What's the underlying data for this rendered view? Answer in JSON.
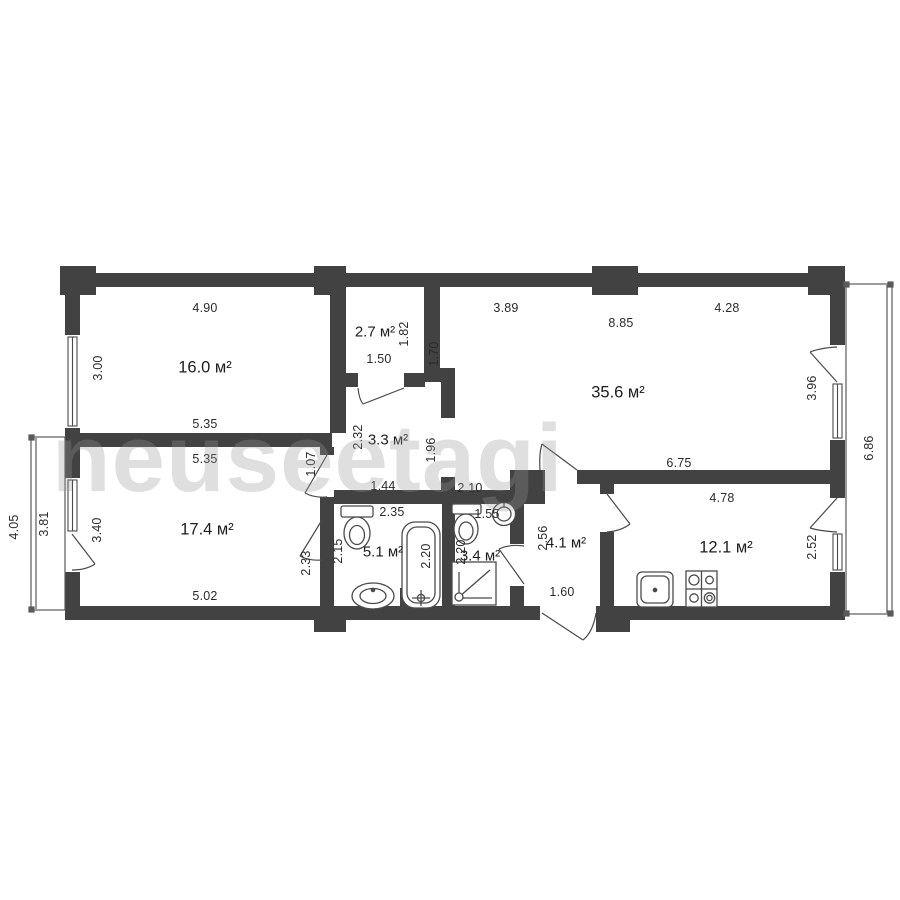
{
  "colors": {
    "wall": "#424242",
    "line": "#4a4a4a",
    "text": "#2b2b2b",
    "watermark": "#c9c9c9"
  },
  "watermark": {
    "text": "neuseetagi"
  },
  "plan": {
    "rooms": {
      "r16": {
        "area_label": "16.0 м²"
      },
      "r27": {
        "area_label": "2.7 м²"
      },
      "r356": {
        "area_label": "35.6 м²"
      },
      "h33": {
        "area_label": "3.3 м²"
      },
      "r174": {
        "area_label": "17.4 м²"
      },
      "b51": {
        "area_label": "5.1 м²"
      },
      "b34": {
        "area_label": "3.4 м²"
      },
      "h41": {
        "area_label": "4.1 м²"
      },
      "k121": {
        "area_label": "12.1 м²"
      }
    },
    "dims": {
      "r16_top": "4.90",
      "r16_left": "3.00",
      "r16_bottom": "5.35",
      "r17_top": "5.35",
      "r17_left": "3.40",
      "r17_bottom": "5.02",
      "r27_bottom": "1.50",
      "r27_right": "1.82",
      "wall_170": "1.70",
      "r356_top_left": "3.89",
      "r356_top_mid": "8.85",
      "r356_top_right": "4.28",
      "r356_right": "3.96",
      "r356_bottom": "6.75",
      "balcony_right": "6.86",
      "h33_left": "2.32",
      "h33_right": "1.96",
      "h33_bottom": "1.44",
      "h33_door": "1.07",
      "corridor": "2.10",
      "b51_top": "2.35",
      "b51_left": "2.15",
      "b51_wall": "2.33",
      "bathtub": "2.20",
      "b34_top": "1.55",
      "b34_left": "2.20",
      "h41_left": "2.56",
      "entrance": "1.60",
      "k_top": "4.78",
      "k_right": "2.52",
      "balcony_left_outer": "4.05",
      "balcony_left_inner": "3.81"
    }
  }
}
